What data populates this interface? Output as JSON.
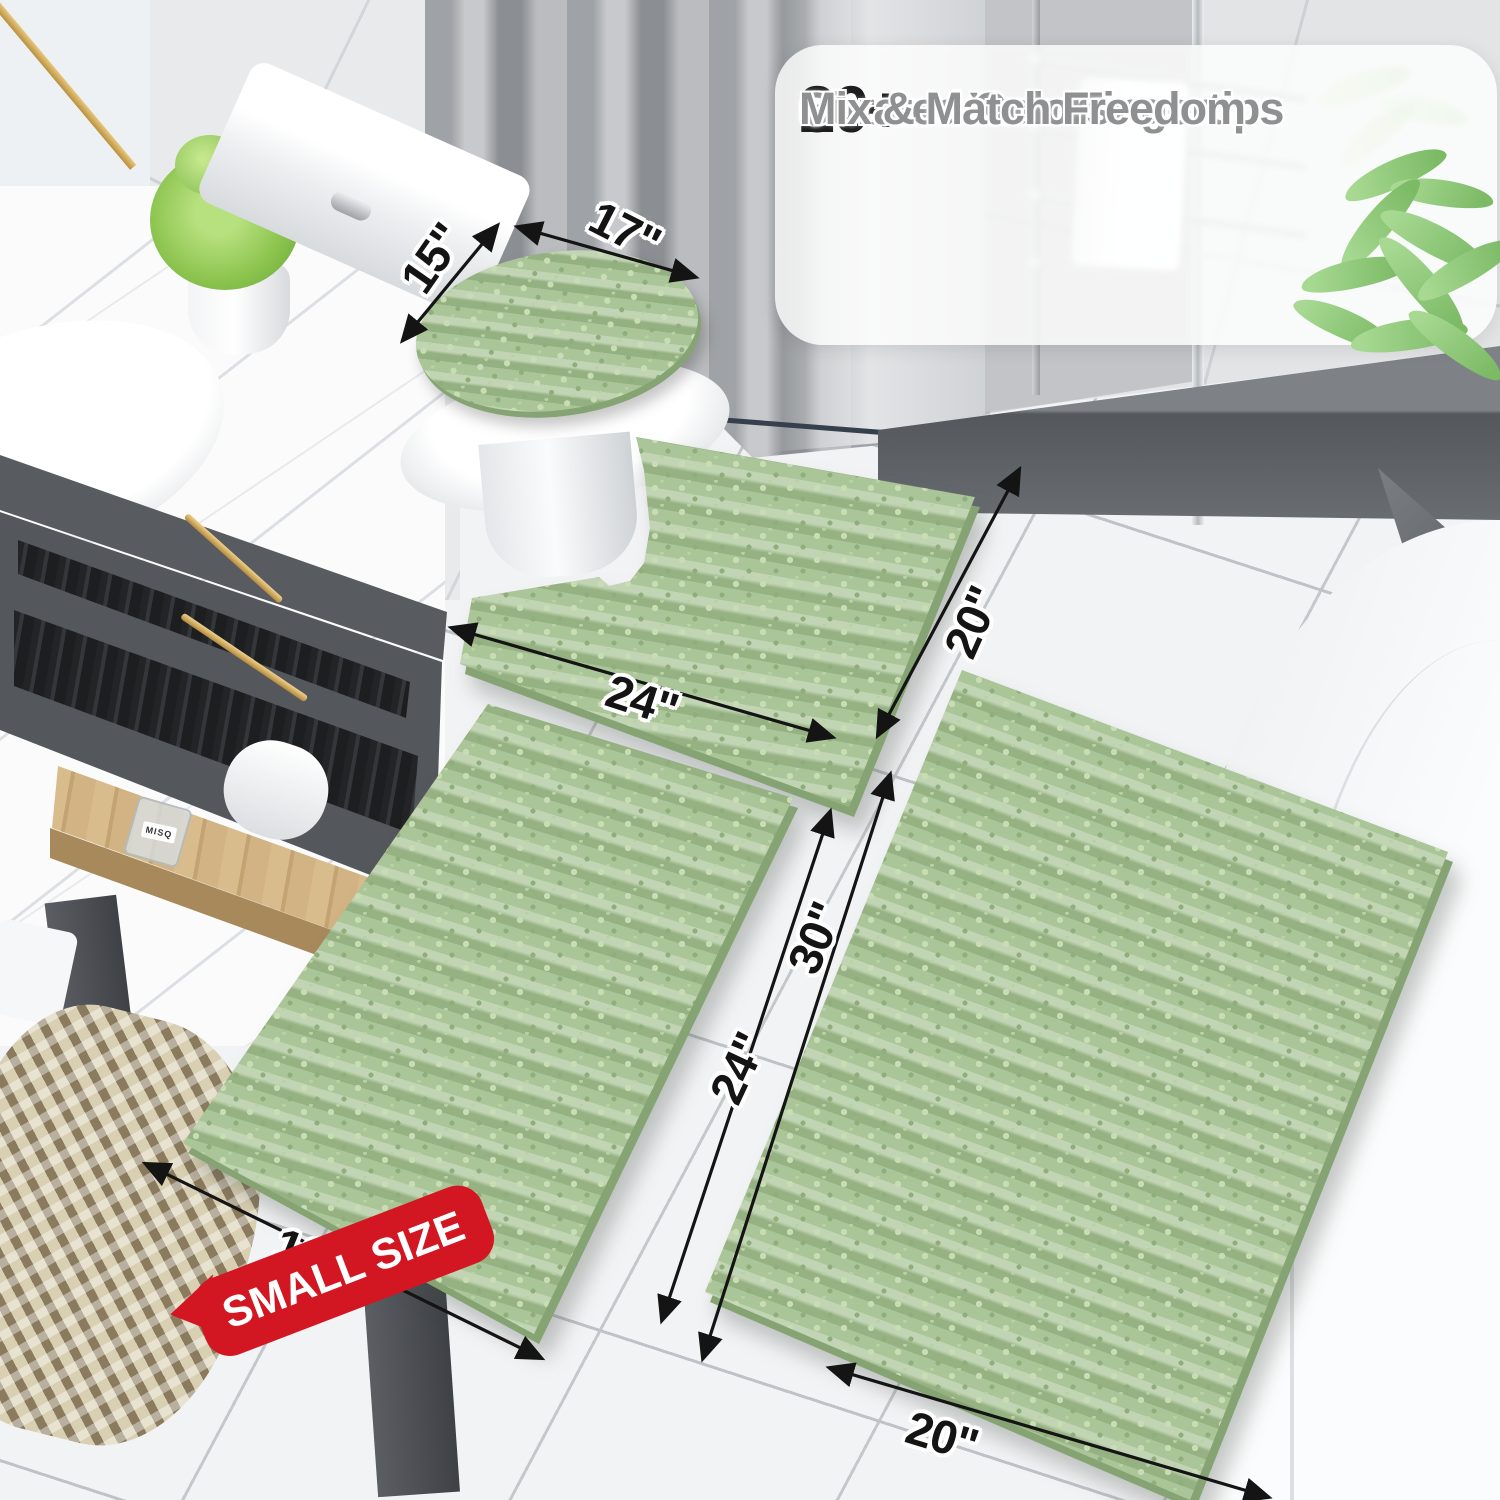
{
  "banner": {
    "features": [
      {
        "check": "✓",
        "count": "20+",
        "label": "Sizes at Your Fingertips"
      },
      {
        "check": "✓",
        "count": "30+",
        "label": "Curated Colors"
      },
      {
        "check": "✓",
        "count": "",
        "label": "Mix & Match Freedom"
      }
    ]
  },
  "annotations": {
    "lid": {
      "width": "17\"",
      "depth": "15\""
    },
    "contour_mat": {
      "width": "24\"",
      "depth": "20\""
    },
    "small_rug": {
      "width": "16\"",
      "length": "24\""
    },
    "large_rug": {
      "width": "20\"",
      "length": "30\""
    }
  },
  "badge": {
    "label": "SMALL SIZE"
  },
  "vanity": {
    "bottle_label": "MISQ"
  },
  "colors": {
    "rug_green": "#a6c293",
    "badge_red": "#d31722",
    "annotation_ink": "#141414",
    "banner_background": "rgba(255,255,255,0.80)",
    "feature_text_gray": "#8f9092",
    "count_black": "#1d1d1f"
  }
}
